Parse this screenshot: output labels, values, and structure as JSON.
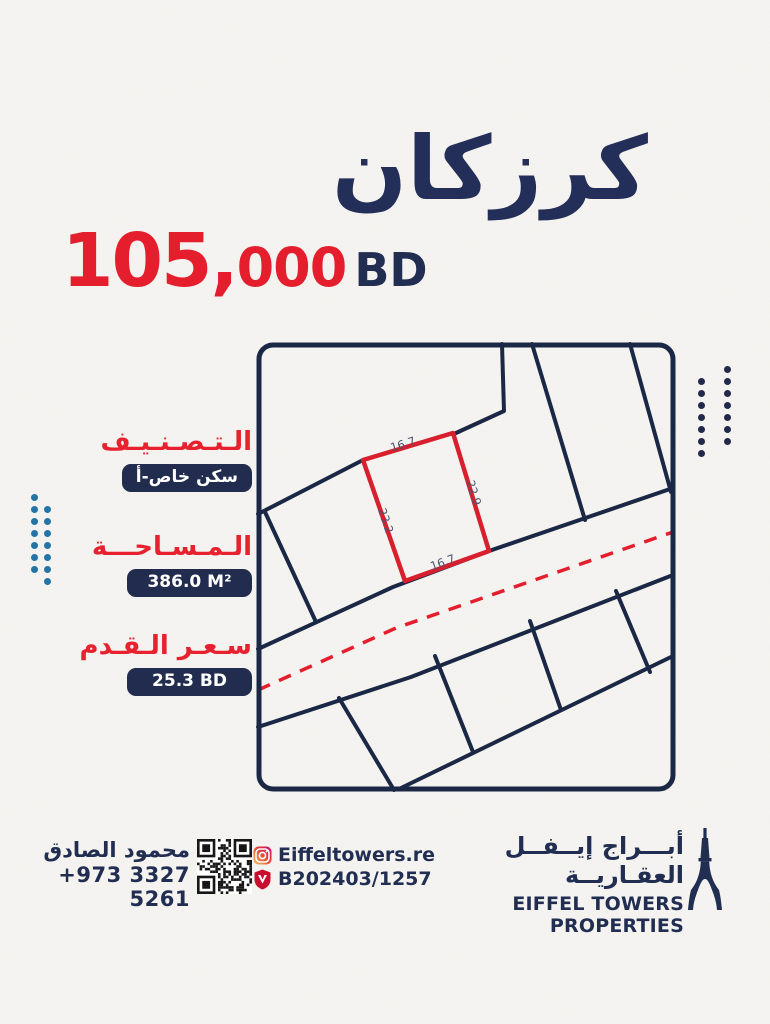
{
  "poster": {
    "title": "كرزكان",
    "price": {
      "amount_major": "105,",
      "amount_minor": "000",
      "currency": "BD"
    },
    "details": [
      {
        "label": "الـتـصـنـيـف",
        "value": "سكن خاص-أ"
      },
      {
        "label": "الـمـسـاحـــة",
        "value": "386.0 M²"
      },
      {
        "label": "سـعـر الـقـدم",
        "value": "25.3 BD"
      }
    ],
    "map": {
      "dimensions": {
        "top": "16.7",
        "right": "22.9",
        "left": "23.2",
        "bottom": "16.7"
      }
    },
    "footer": {
      "agent_name": "محمود الصادق",
      "agent_phone": "+973 3327 5261",
      "instagram_handle": "Eiffeltowers.re",
      "license_number": "B202403/1257",
      "company_name_ar": "أبـــراج إيــفــل العقـاريــة",
      "company_name_en": "EIFFEL TOWERS PROPERTIES"
    },
    "colors": {
      "navy": "#212e52",
      "red": "#e51e2d",
      "map_line": "#1b2845",
      "plot_highlight": "#d81f2e",
      "dots_blue": "#2474a5",
      "paper": "#f5f4f1"
    }
  }
}
